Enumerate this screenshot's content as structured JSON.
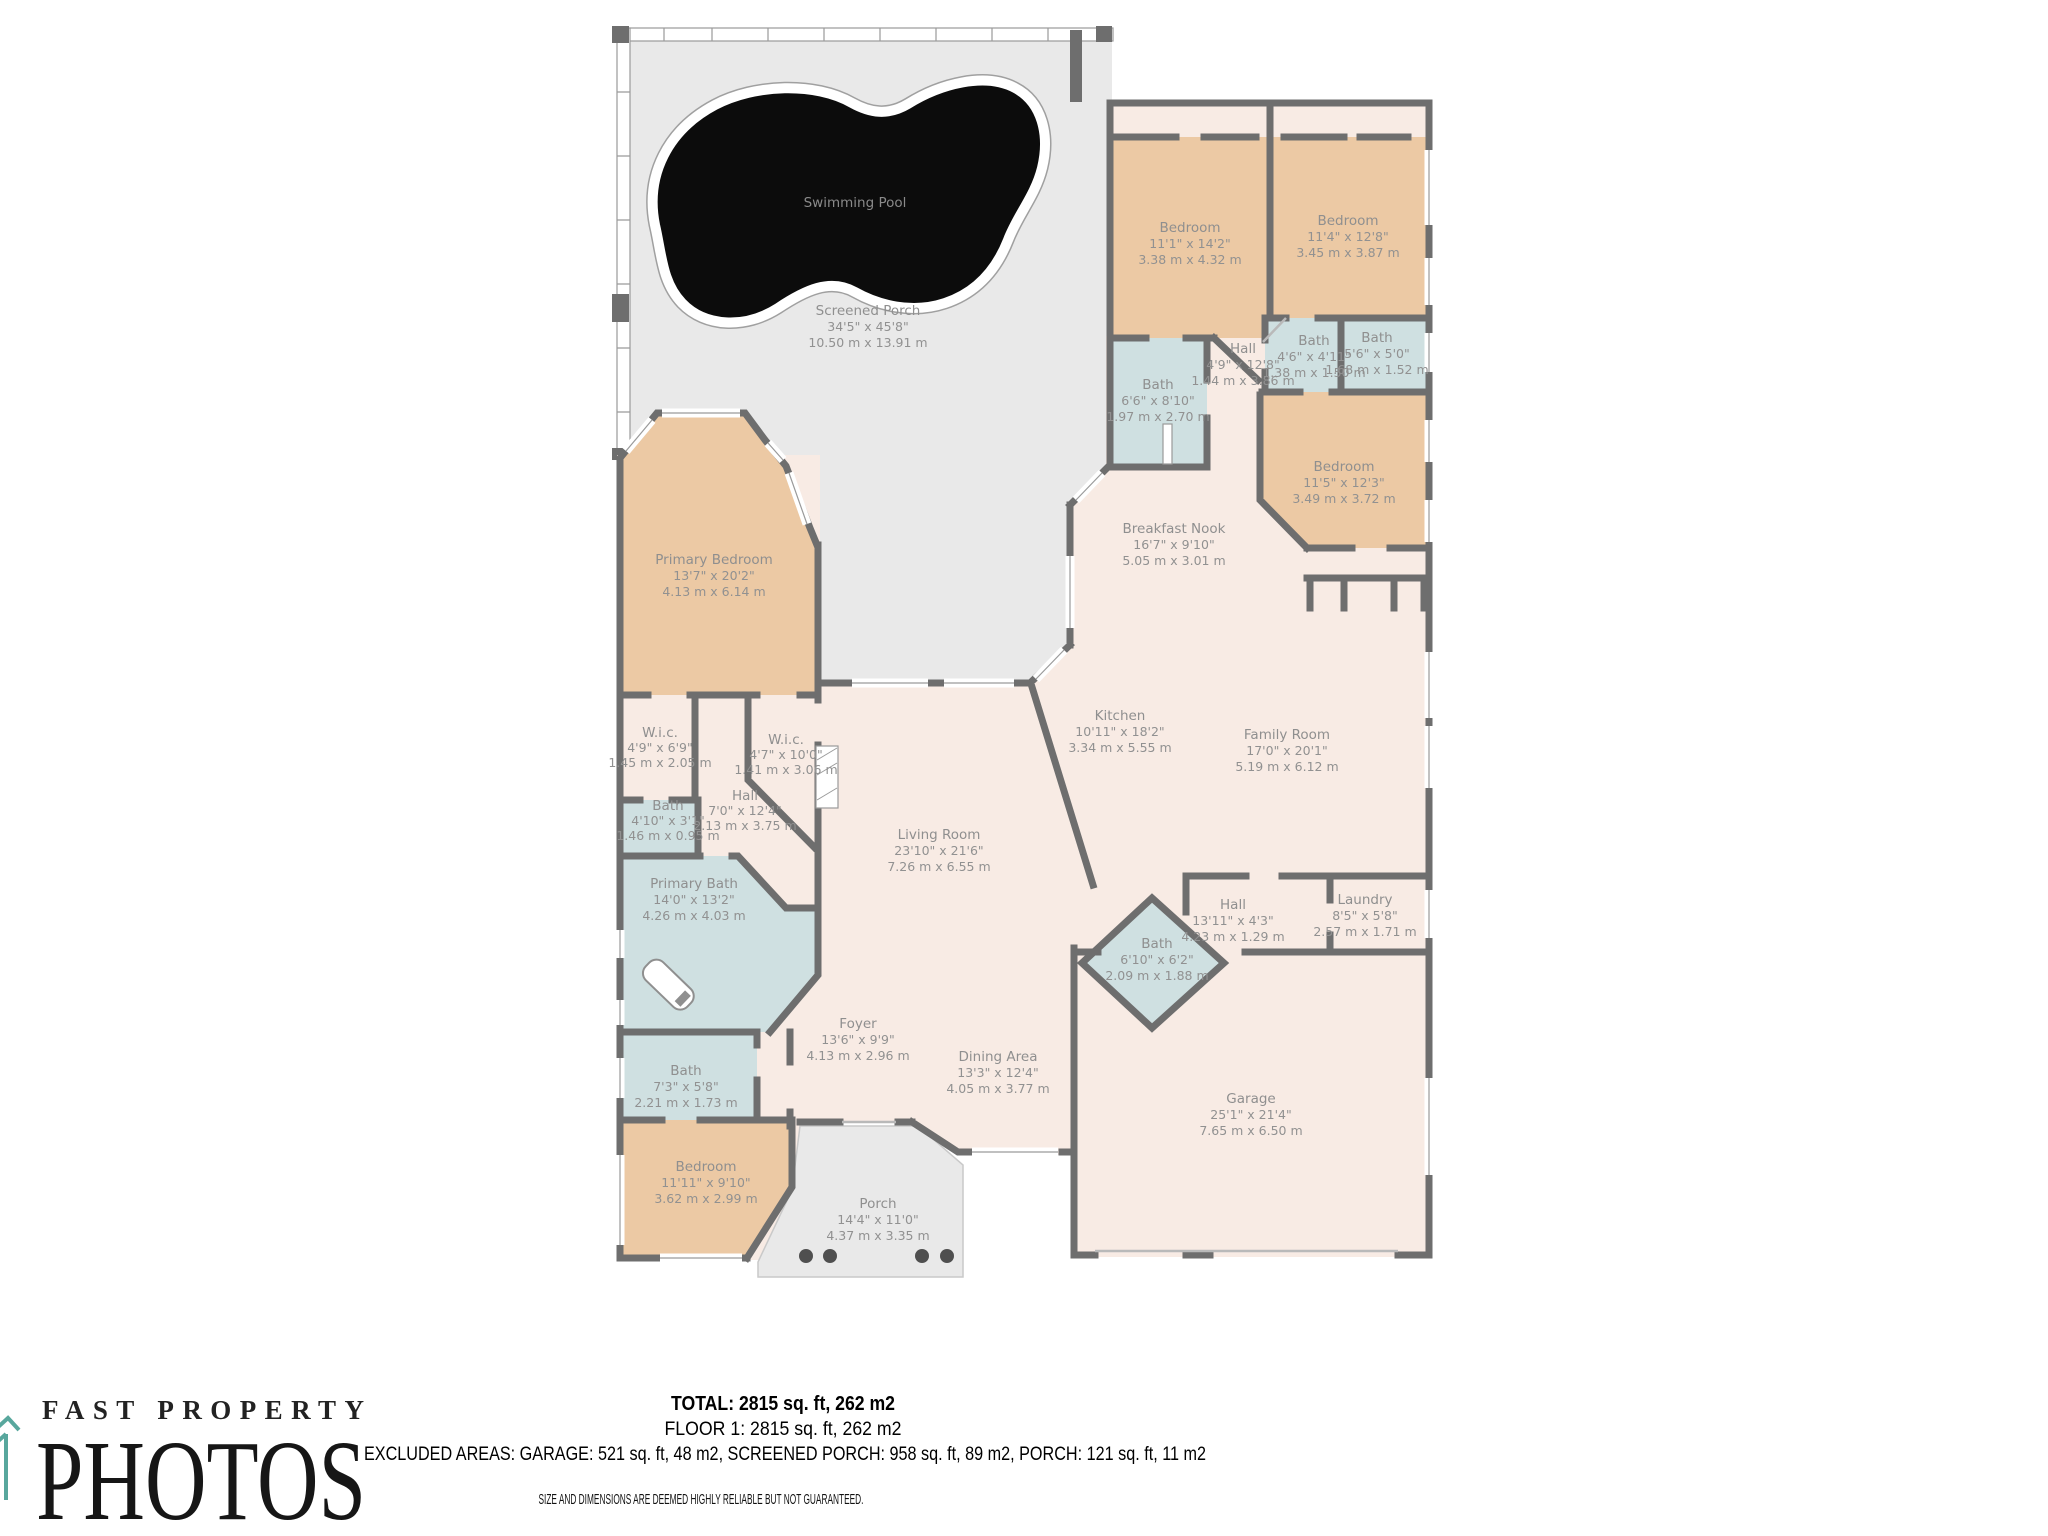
{
  "branding": {
    "name_top": "FAST PROPERTY",
    "name_main": "PHOTOS"
  },
  "summary": {
    "total": "TOTAL: 2815 sq. ft, 262 m2",
    "floor": "FLOOR 1: 2815 sq. ft, 262 m2",
    "excluded": "EXCLUDED AREAS: GARAGE: 521 sq. ft, 48 m2, SCREENED PORCH: 958 sq. ft, 89 m2, PORCH: 121 sq. ft, 11 m2",
    "disclaimer": "SIZE AND DIMENSIONS ARE DEEMED HIGHLY RELIABLE BUT NOT GUARANTEED."
  },
  "colors": {
    "wall": "#6e6e6e",
    "bedroom_fill": "#ecc9a4",
    "bath_fill": "#cfe0e1",
    "interior_fill": "#f8ebe4",
    "porch_fill": "#e9e9e9",
    "pool_fill": "#0c0c0c",
    "label_text": "#8f8f8f",
    "footer_text": "#000000",
    "logo_teal": "#58a79d"
  },
  "rooms": [
    {
      "id": "swimming-pool",
      "name": "Swimming Pool",
      "ft": "",
      "m": ""
    },
    {
      "id": "screened-porch",
      "name": "Screened Porch",
      "ft": "34'5\" x 45'8\"",
      "m": "10.50 m x 13.91 m"
    },
    {
      "id": "bedroom-a",
      "name": "Bedroom",
      "ft": "11'1\" x 14'2\"",
      "m": "3.38 m x 4.32 m"
    },
    {
      "id": "bedroom-b",
      "name": "Bedroom",
      "ft": "11'4\" x 12'8\"",
      "m": "3.45 m x 3.87 m"
    },
    {
      "id": "hall-a",
      "name": "Hall",
      "ft": "4'9\" x 12'8\"",
      "m": "1.44 m x 3.86 m"
    },
    {
      "id": "bath-a",
      "name": "Bath",
      "ft": "4'6\" x 4'11\"",
      "m": "1.38 m x 1.50 m"
    },
    {
      "id": "bath-b",
      "name": "Bath",
      "ft": "5'6\" x 5'0\"",
      "m": "1.68 m x 1.52 m"
    },
    {
      "id": "bath-c",
      "name": "Bath",
      "ft": "6'6\" x 8'10\"",
      "m": "1.97 m x 2.70 m"
    },
    {
      "id": "bedroom-c",
      "name": "Bedroom",
      "ft": "11'5\" x 12'3\"",
      "m": "3.49 m x 3.72 m"
    },
    {
      "id": "breakfast-nook",
      "name": "Breakfast Nook",
      "ft": "16'7\" x 9'10\"",
      "m": "5.05 m x 3.01 m"
    },
    {
      "id": "primary-bedroom",
      "name": "Primary Bedroom",
      "ft": "13'7\" x 20'2\"",
      "m": "4.13 m x 6.14 m"
    },
    {
      "id": "wic-a",
      "name": "W.i.c.",
      "ft": "4'9\" x 6'9\"",
      "m": "1.45 m x 2.05 m"
    },
    {
      "id": "wic-b",
      "name": "W.i.c.",
      "ft": "4'7\" x 10'0\"",
      "m": "1.41 m x 3.06 m"
    },
    {
      "id": "hall-b",
      "name": "Hall",
      "ft": "7'0\" x 12'4\"",
      "m": "2.13 m x 3.75 m"
    },
    {
      "id": "bath-d",
      "name": "Bath",
      "ft": "4'10\" x 3'1\"",
      "m": "1.46 m x 0.95 m"
    },
    {
      "id": "primary-bath",
      "name": "Primary Bath",
      "ft": "14'0\" x 13'2\"",
      "m": "4.26 m x 4.03 m"
    },
    {
      "id": "foyer",
      "name": "Foyer",
      "ft": "13'6\" x 9'9\"",
      "m": "4.13 m x 2.96 m"
    },
    {
      "id": "bath-e",
      "name": "Bath",
      "ft": "7'3\" x 5'8\"",
      "m": "2.21 m x 1.73 m"
    },
    {
      "id": "bedroom-d",
      "name": "Bedroom",
      "ft": "11'11\" x 9'10\"",
      "m": "3.62 m x 2.99 m"
    },
    {
      "id": "porch",
      "name": "Porch",
      "ft": "14'4\" x 11'0\"",
      "m": "4.37 m x 3.35 m"
    },
    {
      "id": "dining-area",
      "name": "Dining Area",
      "ft": "13'3\" x 12'4\"",
      "m": "4.05 m x 3.77 m"
    },
    {
      "id": "living-room",
      "name": "Living Room",
      "ft": "23'10\" x 21'6\"",
      "m": "7.26 m x 6.55 m"
    },
    {
      "id": "kitchen",
      "name": "Kitchen",
      "ft": "10'11\" x 18'2\"",
      "m": "3.34 m x 5.55 m"
    },
    {
      "id": "family-room",
      "name": "Family Room",
      "ft": "17'0\" x 20'1\"",
      "m": "5.19 m x 6.12 m"
    },
    {
      "id": "hall-c",
      "name": "Hall",
      "ft": "13'11\" x 4'3\"",
      "m": "4.23 m x 1.29 m"
    },
    {
      "id": "laundry",
      "name": "Laundry",
      "ft": "8'5\" x 5'8\"",
      "m": "2.57 m x 1.71 m"
    },
    {
      "id": "bath-f",
      "name": "Bath",
      "ft": "6'10\" x 6'2\"",
      "m": "2.09 m x 1.88 m"
    },
    {
      "id": "garage",
      "name": "Garage",
      "ft": "25'1\" x 21'4\"",
      "m": "7.65 m x 6.50 m"
    }
  ]
}
